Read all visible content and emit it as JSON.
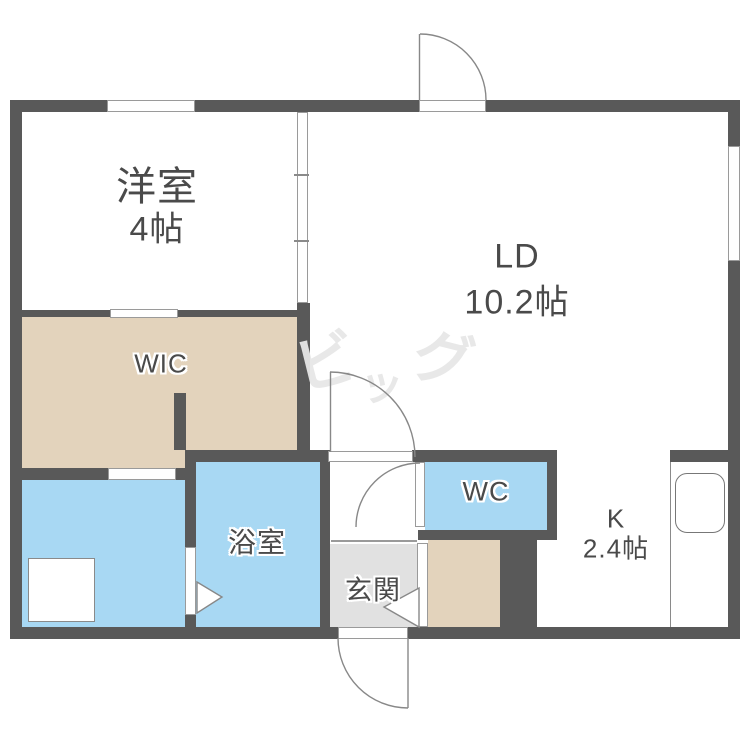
{
  "floorplan": {
    "rooms": [
      {
        "id": "yoshitsu",
        "label": "洋室",
        "size": "4帖",
        "fill": "#ffffff"
      },
      {
        "id": "ld",
        "label": "LD",
        "size": "10.2帖",
        "fill": "#ffffff"
      },
      {
        "id": "wic",
        "label": "WIC",
        "fill": "#e3d3bc"
      },
      {
        "id": "washroom",
        "label": "",
        "fill": "#a8d8f3"
      },
      {
        "id": "bathroom",
        "label": "浴室",
        "fill": "#a8d8f3"
      },
      {
        "id": "wc",
        "label": "WC",
        "fill": "#a8d8f3"
      },
      {
        "id": "genkan",
        "label": "玄関",
        "fill": "#e1e1e1"
      },
      {
        "id": "closet",
        "label": "",
        "fill": "#e3d3bc"
      },
      {
        "id": "kitchen",
        "label": "K",
        "size": "2.4帖",
        "fill": "#ffffff"
      }
    ],
    "watermark": {
      "chars": [
        "ビ",
        "ッ",
        "グ"
      ],
      "color": "#e7e7e7"
    },
    "colors": {
      "wall": "#595959",
      "tan": "#e3d3bc",
      "blue": "#a8d8f3",
      "genkan_gray": "#e1e1e1",
      "door_line": "#888888",
      "text": "#4a4a4a"
    }
  }
}
